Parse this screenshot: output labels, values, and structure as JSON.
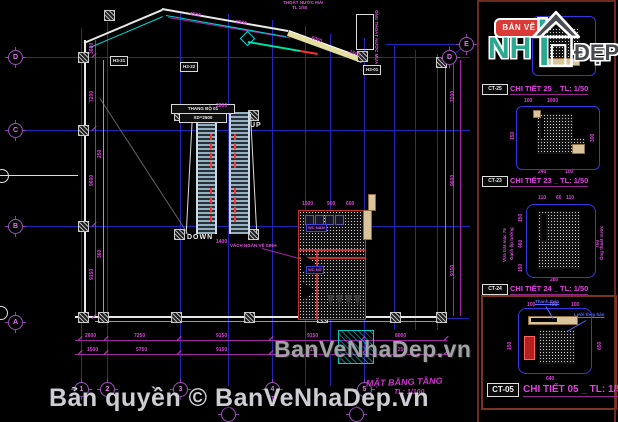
{
  "branding": {
    "logo_small_text": "BẢN VẼ",
    "logo_nh": "NH",
    "logo_dep": "ĐẸP",
    "watermark": "BanVeNhaDep.vn",
    "copyright": "Bản quyền © BanVeNhaDep.vn"
  },
  "plan": {
    "title_line": "MẶT BẰNG TẦNG",
    "title_scale": "TL: 1/100",
    "up": "UP",
    "down": "DOWN",
    "stair_label": "THANG BỘ 01",
    "stair_sub": "XD=2500",
    "wc_label_1": "WC NAM",
    "wc_label_2": "WC NỮ",
    "tags": [
      "H3-21",
      "H3-22",
      "H3-01"
    ],
    "bubbles": [
      {
        "l": "D",
        "x": 15,
        "y": 57
      },
      {
        "l": "C",
        "x": 15,
        "y": 130
      },
      {
        "l": "B",
        "x": 15,
        "y": 226
      },
      {
        "l": "A",
        "x": 15,
        "y": 322
      },
      {
        "l": "E",
        "x": 466,
        "y": 44
      },
      {
        "l": "D",
        "x": 449,
        "y": 57
      },
      {
        "l": "1",
        "x": 81,
        "y": 389
      },
      {
        "l": "2",
        "x": 107,
        "y": 389
      },
      {
        "l": "3",
        "x": 180,
        "y": 389
      },
      {
        "l": "4",
        "x": 272,
        "y": 389
      },
      {
        "l": "5",
        "x": 364,
        "y": 389
      },
      {
        "l": "",
        "x": 228,
        "y": 414
      },
      {
        "l": "",
        "x": 356,
        "y": 414
      }
    ],
    "dims": [
      {
        "t": "2600",
        "x": 85,
        "y": 334
      },
      {
        "t": "7250",
        "x": 134,
        "y": 334
      },
      {
        "t": "9150",
        "x": 216,
        "y": 334
      },
      {
        "t": "9150",
        "x": 307,
        "y": 334
      },
      {
        "t": "8000",
        "x": 395,
        "y": 334
      },
      {
        "t": "1500",
        "x": 87,
        "y": 348
      },
      {
        "t": "5750",
        "x": 136,
        "y": 348
      },
      {
        "t": "9150",
        "x": 216,
        "y": 348
      },
      {
        "t": "9150",
        "x": 307,
        "y": 348
      },
      {
        "t": "7250",
        "x": 395,
        "y": 348
      },
      {
        "t": "3600",
        "x": 90,
        "y": 54,
        "r": -90
      },
      {
        "t": "7200",
        "x": 90,
        "y": 102,
        "r": -90
      },
      {
        "t": "9600",
        "x": 90,
        "y": 186,
        "r": -90
      },
      {
        "t": "9150",
        "x": 90,
        "y": 280,
        "r": -90
      },
      {
        "t": "7200",
        "x": 451,
        "y": 102,
        "r": -90
      },
      {
        "t": "9600",
        "x": 451,
        "y": 186,
        "r": -90
      },
      {
        "t": "9150",
        "x": 451,
        "y": 276,
        "r": -90
      },
      {
        "t": "250",
        "x": 98,
        "y": 158,
        "r": -90
      },
      {
        "t": "360",
        "x": 98,
        "y": 258,
        "r": -90
      },
      {
        "t": "4500",
        "x": 190,
        "y": 12,
        "r": 10
      },
      {
        "t": "2500",
        "x": 236,
        "y": 20,
        "r": 10
      },
      {
        "t": "6000",
        "x": 312,
        "y": 36,
        "r": 20
      },
      {
        "t": "1500",
        "x": 350,
        "y": 50,
        "r": 20
      },
      {
        "t": "1500",
        "x": 302,
        "y": 202
      },
      {
        "t": "900",
        "x": 327,
        "y": 202
      },
      {
        "t": "600",
        "x": 346,
        "y": 202
      },
      {
        "t": "2800",
        "x": 216,
        "y": 104
      },
      {
        "t": "1400",
        "x": 216,
        "y": 240
      },
      {
        "t": "100",
        "x": 524,
        "y": 99
      },
      {
        "t": "1000",
        "x": 547,
        "y": 99
      },
      {
        "t": "150",
        "x": 511,
        "y": 140,
        "r": -90
      },
      {
        "t": "300",
        "x": 591,
        "y": 142,
        "r": -90
      },
      {
        "t": "240",
        "x": 538,
        "y": 170
      },
      {
        "t": "100",
        "x": 565,
        "y": 170
      },
      {
        "t": "110",
        "x": 538,
        "y": 196
      },
      {
        "t": "60",
        "x": 556,
        "y": 196
      },
      {
        "t": "110",
        "x": 566,
        "y": 196
      },
      {
        "t": "150",
        "x": 519,
        "y": 222,
        "r": -90
      },
      {
        "t": "460",
        "x": 519,
        "y": 248,
        "r": -90
      },
      {
        "t": "150",
        "x": 519,
        "y": 272,
        "r": -90
      },
      {
        "t": "760",
        "x": 596,
        "y": 248,
        "r": -90
      },
      {
        "t": "280",
        "x": 550,
        "y": 278
      },
      {
        "t": "100",
        "x": 527,
        "y": 303
      },
      {
        "t": "700",
        "x": 549,
        "y": 303
      },
      {
        "t": "100",
        "x": 571,
        "y": 303
      },
      {
        "t": "150",
        "x": 508,
        "y": 350,
        "r": -90
      },
      {
        "t": "650",
        "x": 598,
        "y": 350,
        "r": -90
      },
      {
        "t": "640",
        "x": 546,
        "y": 377
      }
    ],
    "notes": [
      {
        "t": "VÁCH NGĂN VỆ SINH",
        "x": 230,
        "y": 244,
        "c": "m"
      },
      {
        "t": "ỐNG THOÁT NƯỚC MƯA",
        "x": 378,
        "y": 10,
        "r": 90,
        "c": "m"
      },
      {
        "t": "THOÁT NƯỚC MÁI",
        "x": 283,
        "y": 1,
        "c": "m"
      },
      {
        "t": "TL 1/50",
        "x": 292,
        "y": 6,
        "c": "m"
      },
      {
        "t": "Vữa trát mác 75",
        "x": 503,
        "y": 262,
        "r": -90,
        "c": "m"
      },
      {
        "t": "Gạch ốp tường",
        "x": 510,
        "y": 260,
        "r": -90,
        "c": "m"
      },
      {
        "t": "Ống thoát nước",
        "x": 600,
        "y": 260,
        "r": -90,
        "c": "m"
      },
      {
        "t": "Thanh thép",
        "x": 535,
        "y": 300,
        "c": "b"
      },
      {
        "t": "Lưới thép hàn",
        "x": 574,
        "y": 313,
        "c": "b"
      }
    ]
  },
  "details": [
    {
      "tag": "CT-25",
      "label": "CHI TIẾT 25 _ TL: 1/50"
    },
    {
      "tag": "CT-23",
      "label": "CHI TIẾT 23 _ TL: 1/50"
    },
    {
      "tag": "CT-24",
      "label": "CHI TIẾT 24 _ TL: 1/50"
    },
    {
      "tag": "CT-05",
      "label": "CHI TIẾT 05 _ TL: 1/50"
    }
  ]
}
